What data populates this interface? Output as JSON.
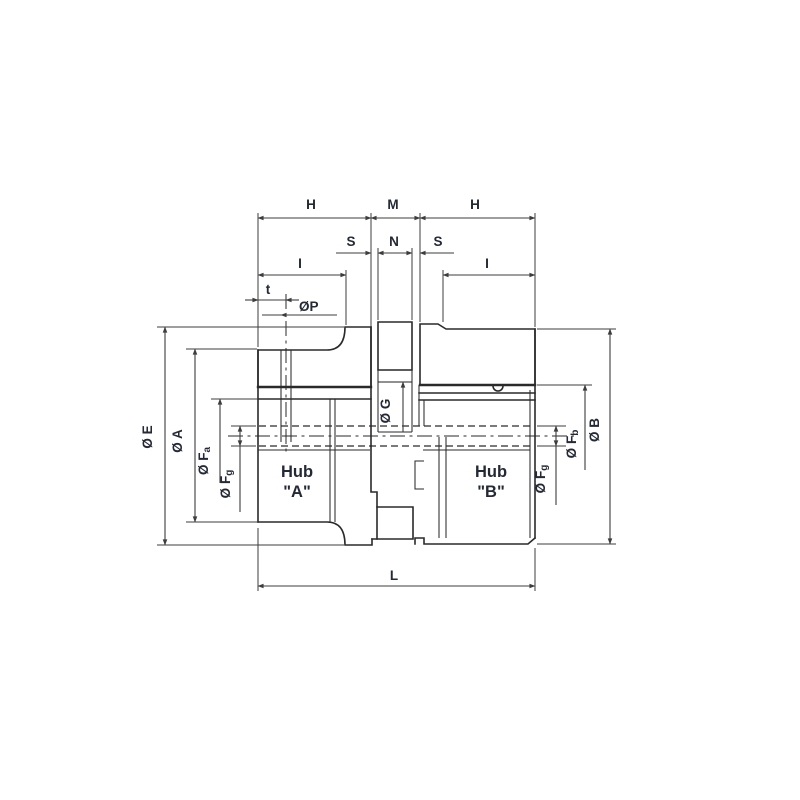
{
  "drawing": {
    "dimensions": {
      "h_left": "H",
      "m": "M",
      "h_right": "H",
      "s_left": "S",
      "n": "N",
      "s_right": "S",
      "i_left": "I",
      "i_right": "I",
      "t": "t",
      "l": "L"
    },
    "diameter_labels": {
      "dia_e": {
        "pre": "Ø ",
        "main": "E",
        "sub": ""
      },
      "dia_a": {
        "pre": "Ø ",
        "main": "A",
        "sub": ""
      },
      "dia_fa": {
        "pre": "Ø ",
        "main": "F",
        "sub": "a"
      },
      "dia_fg_left": {
        "pre": "Ø ",
        "main": "F",
        "sub": "g"
      },
      "dia_g": {
        "pre": "Ø ",
        "main": "G",
        "sub": ""
      },
      "dia_p": {
        "pre": "Ø",
        "main": "P",
        "sub": ""
      },
      "dia_fb": {
        "pre": "Ø ",
        "main": "F",
        "sub": "b"
      },
      "dia_fg_right": {
        "pre": "Ø ",
        "main": "F",
        "sub": "g"
      },
      "dia_b": {
        "pre": "Ø ",
        "main": "B",
        "sub": ""
      }
    },
    "hubs": {
      "a_line1": "Hub",
      "a_line2": "\"A\"",
      "b_line1": "Hub",
      "b_line2": "\"B\""
    },
    "colors": {
      "line": "#2a2a2a",
      "dimension": "#3d3d3d",
      "text": "#242936",
      "background": "#ffffff"
    }
  }
}
